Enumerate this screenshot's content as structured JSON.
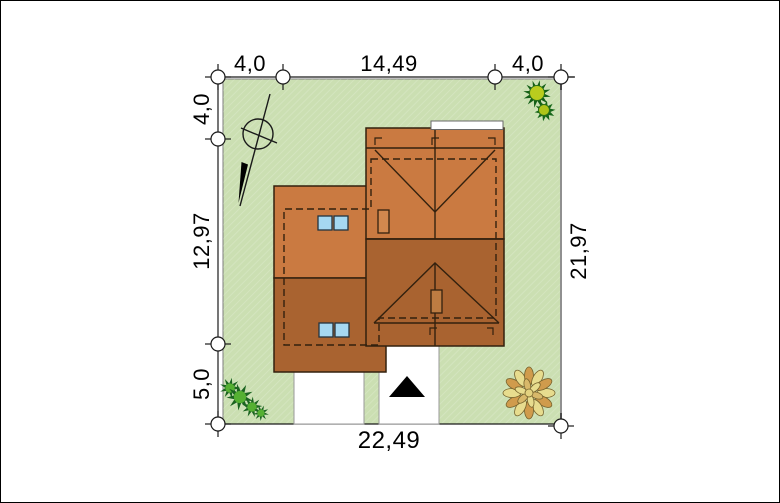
{
  "site_plan": {
    "dimensions": {
      "top_setback_left": "4,0",
      "top_width": "14,49",
      "top_setback_right": "4,0",
      "left_setback_top": "4,0",
      "left_height": "12,97",
      "left_setback_bottom": "5,0",
      "right_height": "21,97",
      "bottom_width": "22,49"
    },
    "icons": {
      "north_arrow": "north-arrow-icon",
      "survey_marker": "survey-marker-icon",
      "entrance_arrow": "entrance-arrow-icon",
      "shrub": "shrub-icon",
      "flower_bed": "flower-bed-icon",
      "skylight": "skylight-window-icon",
      "chimney": "chimney-icon",
      "roof_dormer": "dormer-icon"
    },
    "colors": {
      "lawn_green": "#cbdfb2",
      "roof_light": "#ca7a41",
      "roof_dark": "#a96330",
      "chimney_light": "#d2884e",
      "chimney_dark": "#bd7c42",
      "skylight_blue": "#a6d8f1",
      "paving_white": "#ffffff",
      "outline_dark": "#33210e"
    }
  }
}
